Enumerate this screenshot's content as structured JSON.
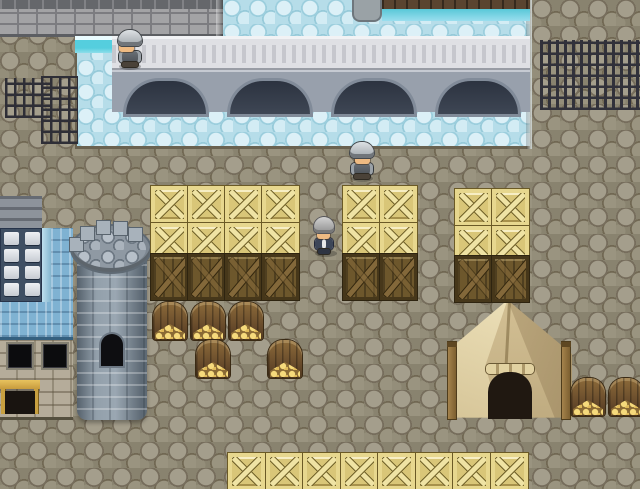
{
  "app": {
    "type": "rpg-game-viewport"
  },
  "viewport": {
    "width": 640,
    "height": 489
  },
  "palette": {
    "ground_cobble": "#89836f",
    "water": "#b6dde9",
    "water_edge_teal": "#55cede",
    "bridge_deck": "#dfe0e4",
    "bridge_arch_shadow": "#2c3340",
    "stone_wall": "#a3a3a5",
    "crate_light": "#e7d78e",
    "crate_dark": "#6d572c",
    "bin_wood": "#7a5c30",
    "gold": "#f0d06a",
    "tent_canvas": "#d6c598",
    "tent_opening": "#201811",
    "tower_stone": "#93a0ab",
    "roof_blue": "#7fb2d2",
    "slate_facade": "#3f4f63",
    "awning_wood": "#d8b050",
    "iron": "#2e2e36"
  },
  "sprites": {
    "light-crate": [
      [
        151,
        186
      ],
      [
        188,
        186
      ],
      [
        225,
        186
      ],
      [
        262,
        186
      ],
      [
        151,
        223
      ],
      [
        188,
        223
      ],
      [
        225,
        223
      ],
      [
        262,
        223
      ],
      [
        343,
        186
      ],
      [
        380,
        186
      ],
      [
        343,
        223
      ],
      [
        380,
        223
      ],
      [
        455,
        189
      ],
      [
        492,
        189
      ],
      [
        455,
        226
      ],
      [
        492,
        226
      ],
      [
        228,
        453
      ],
      [
        266,
        453
      ],
      [
        303,
        453
      ],
      [
        341,
        453
      ],
      [
        378,
        453
      ],
      [
        416,
        453
      ],
      [
        453,
        453
      ],
      [
        491,
        453
      ]
    ],
    "dark-crate": [
      [
        151,
        254
      ],
      [
        188,
        254
      ],
      [
        225,
        254
      ],
      [
        262,
        254
      ],
      [
        343,
        254
      ],
      [
        380,
        254
      ],
      [
        455,
        256
      ],
      [
        492,
        256
      ]
    ],
    "bin": [
      [
        153,
        302
      ],
      [
        191,
        302
      ],
      [
        229,
        302
      ],
      [
        196,
        340
      ],
      [
        268,
        340
      ],
      [
        571,
        378
      ],
      [
        609,
        378
      ]
    ]
  },
  "characters": [
    {
      "type": "soldier",
      "name": "soldier-on-bridge",
      "x": 116,
      "y": 30,
      "facing": "left"
    },
    {
      "type": "soldier",
      "name": "soldier-by-crates",
      "x": 348,
      "y": 142,
      "facing": "down"
    },
    {
      "type": "villager",
      "name": "gray-haired-villager",
      "x": 312,
      "y": 217,
      "facing": "down"
    }
  ],
  "structures": [
    {
      "name": "stone-bridge"
    },
    {
      "name": "river"
    },
    {
      "name": "watchtower"
    },
    {
      "name": "blue-roof-building"
    },
    {
      "name": "canvas-tent"
    },
    {
      "name": "iron-grates"
    },
    {
      "name": "iron-fence"
    },
    {
      "name": "wooden-dock"
    }
  ]
}
